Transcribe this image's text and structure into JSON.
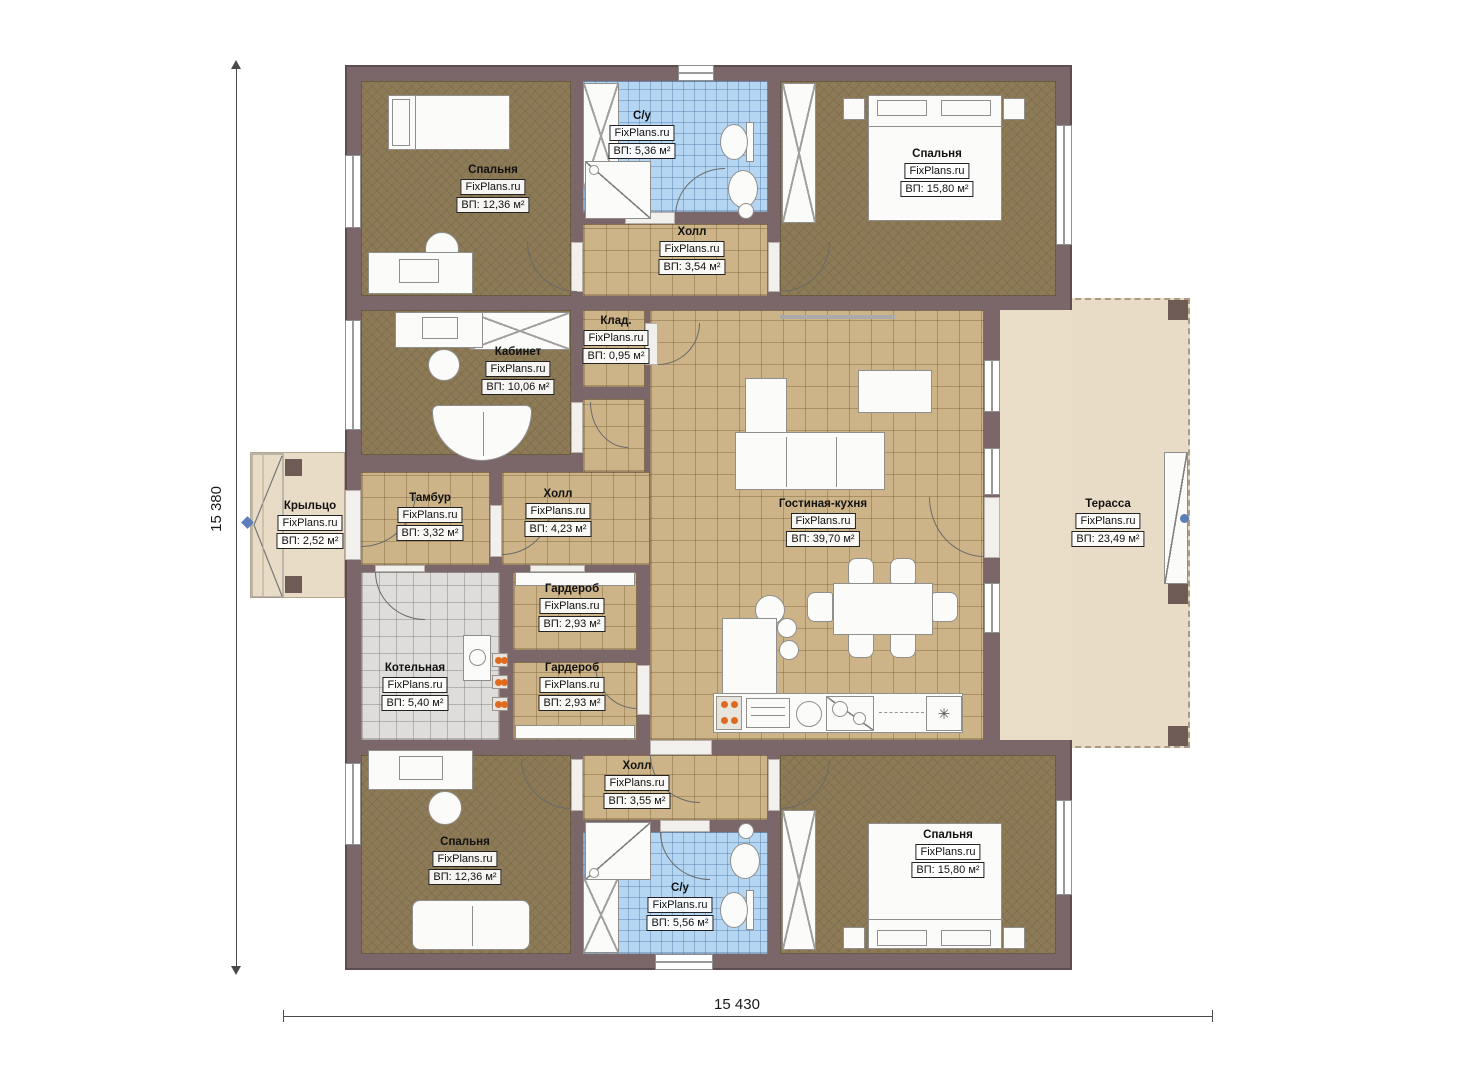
{
  "brand": "FixPlans.ru",
  "dimensions": {
    "height_label": "15 380",
    "width_label": "15 430"
  },
  "icons": {
    "snowflake": "✳"
  },
  "palette": {
    "wall": "#7b6669",
    "bedroom_floor": "#8d7a57",
    "hall_floor": "#cdb488",
    "bath_floor": "#b5d6f2",
    "terrace_floor": "#e9dcc7",
    "boiler_floor": "#dedddb",
    "burner_orange": "#e06a20",
    "marker_blue": "#5b7db8"
  },
  "rooms": [
    {
      "id": "bedroom-tl",
      "name": "Спальня",
      "area": "ВП: 12,36 м²"
    },
    {
      "id": "su-top",
      "name": "С/у",
      "area": "ВП: 5,36 м²"
    },
    {
      "id": "bedroom-tr",
      "name": "Спальня",
      "area": "ВП: 15,80 м²"
    },
    {
      "id": "hall-top",
      "name": "Холл",
      "area": "ВП: 3,54 м²"
    },
    {
      "id": "klad",
      "name": "Клад.",
      "area": "ВП: 0,95 м²"
    },
    {
      "id": "kabinet",
      "name": "Кабинет",
      "area": "ВП: 10,06 м²"
    },
    {
      "id": "living",
      "name": "Гостиная-кухня",
      "area": "ВП: 39,70 м²"
    },
    {
      "id": "terrace",
      "name": "Терасса",
      "area": "ВП: 23,49 м²"
    },
    {
      "id": "porch",
      "name": "Крыльцо",
      "area": "ВП: 2,52 м²"
    },
    {
      "id": "tambur",
      "name": "Тамбур",
      "area": "ВП: 3,32 м²"
    },
    {
      "id": "hall-mid",
      "name": "Холл",
      "area": "ВП: 4,23 м²"
    },
    {
      "id": "garderob-1",
      "name": "Гардероб",
      "area": "ВП: 2,93 м²"
    },
    {
      "id": "kotelnaya",
      "name": "Котельная",
      "area": "ВП: 5,40 м²"
    },
    {
      "id": "garderob-2",
      "name": "Гардероб",
      "area": "ВП: 2,93 м²"
    },
    {
      "id": "hall-bottom",
      "name": "Холл",
      "area": "ВП: 3,55 м²"
    },
    {
      "id": "bedroom-bl",
      "name": "Спальня",
      "area": "ВП: 12,36 м²"
    },
    {
      "id": "su-bottom",
      "name": "С/у",
      "area": "ВП: 5,56 м²"
    },
    {
      "id": "bedroom-br",
      "name": "Спальня",
      "area": "ВП: 15,80 м²"
    }
  ]
}
